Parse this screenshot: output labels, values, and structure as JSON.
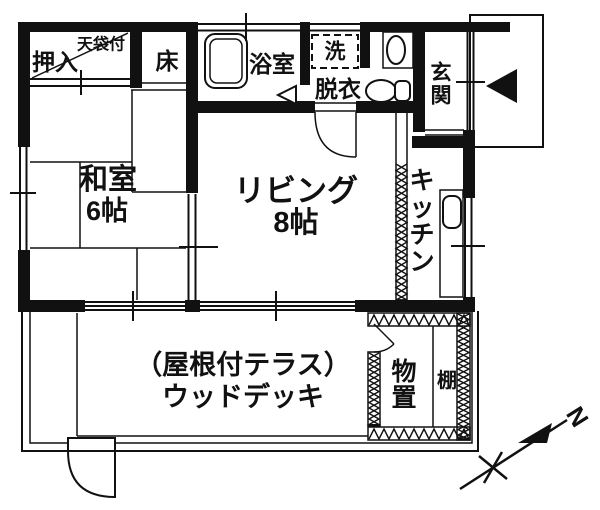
{
  "plan_type": "floor-plan",
  "rooms": {
    "oshiire": {
      "label": "押入"
    },
    "tenbukuro": {
      "label": "天袋付"
    },
    "toko": {
      "label": "床"
    },
    "bathroom": {
      "label": "浴室"
    },
    "washer": {
      "label": "洗"
    },
    "datsui": {
      "label": "脱衣"
    },
    "genkan": {
      "chars": [
        "玄",
        "関"
      ]
    },
    "washitsu": {
      "name": "和室",
      "size": "6帖"
    },
    "living": {
      "name": "リビング",
      "size": "8帖"
    },
    "kitchen": {
      "chars": [
        "キ",
        "ッ",
        "チ",
        "ン"
      ]
    },
    "storage": {
      "chars": [
        "物",
        "置"
      ]
    },
    "shelf": {
      "label": "棚"
    },
    "terrace": {
      "line1": "（屋根付テラス）",
      "line2": "ウッドデッキ"
    }
  },
  "compass": {
    "north": "N"
  },
  "colors": {
    "ink": "#111111",
    "background": "#ffffff"
  }
}
